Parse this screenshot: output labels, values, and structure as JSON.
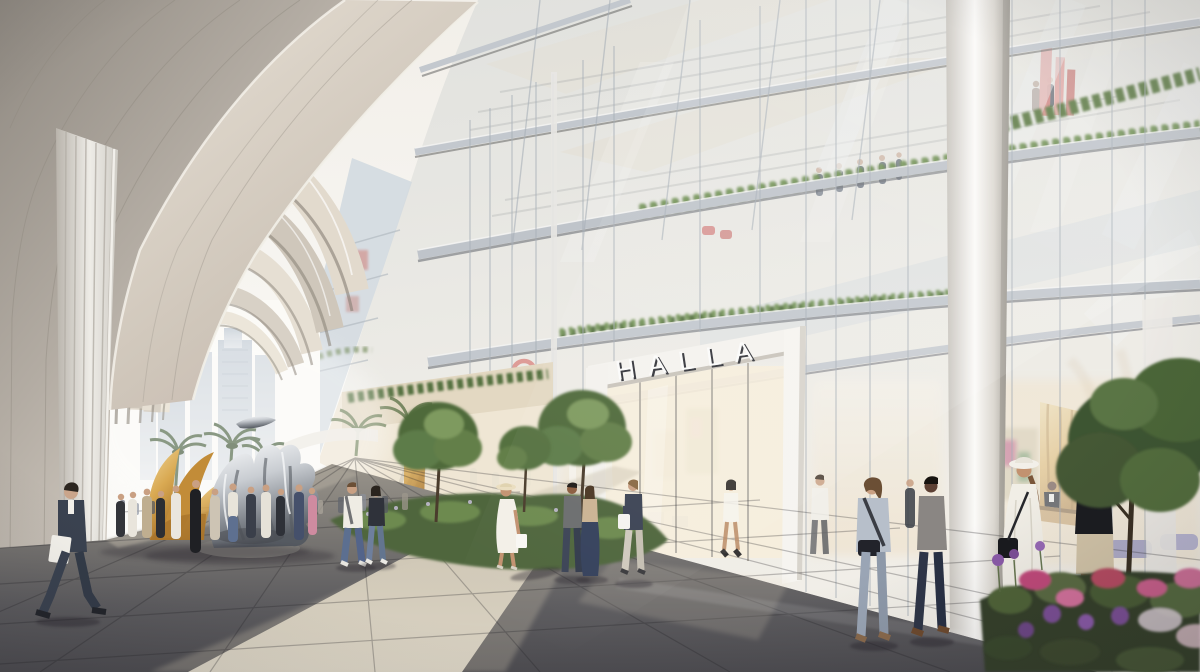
{
  "scene": {
    "type": "architectural-rendering",
    "description": "Sunlit pedestrian promenade beneath a colonnade of sweeping metallic arches, running alongside the tall glass facade of the HALLA building; shoppers stroll past a chrome figure sculpture, a gold winged sculpture, trees, flower beds and a glowing retail lobby.",
    "sign": {
      "text": "HALLA"
    }
  },
  "palette": {
    "sky": "#f5f2ec",
    "arch_light": "#e2dacd",
    "arch_mid": "#c2bab0",
    "arch_shadow": "#8e867d",
    "glass": "#dfe7ee",
    "glass_deep": "#b9c8d6",
    "mullion": "#a8b0b8",
    "sign_face": "#fbfbfa",
    "sign_shade": "#33343a",
    "interior_warm": "#f3e4c9",
    "ground_dark": "#4b4a4e",
    "ground_mid": "#6f6d6a",
    "ground_sunlit": "#d9d2c2",
    "greenery_dark": "#4f6a3b",
    "greenery_light": "#76955a",
    "gold": "#d9a952",
    "chrome_light": "#e9ecef",
    "chrome_dark": "#555a61",
    "accent_red": "#d24a3e",
    "flower_magenta": "#c04a7a",
    "flower_purple": "#7c4f96",
    "wood": "#c49a5e",
    "city_haze": "#c7cfd8",
    "purple_chair": "#7d77a6"
  },
  "elements": {
    "architecture": [
      "nested metallic vault arches",
      "ribbed arch pier",
      "glass curtain wall",
      "white entrance portal",
      "round white column",
      "balconies with hedge planters",
      "wood-slat reception wall"
    ],
    "sculptures": [
      "chrome figures sculpture",
      "gold wing sculpture"
    ],
    "vegetation": [
      "palm trees",
      "courtyard trees",
      "shrub planter",
      "flower bed",
      "street tree"
    ],
    "signage": [
      "HALLA fascia letters",
      "red ring store logo",
      "red art installation"
    ]
  },
  "people": {
    "foreground": [
      "man in dark suit carrying a laptop",
      "man in white t-shirt and jeans",
      "woman in black top and jeans",
      "woman in white dress with straw hat and shopping bag",
      "man in grey sweater at window",
      "woman in beige top and long navy skirt",
      "woman in navy blazer with white tote",
      "woman in striped blue shirt and jeans",
      "man in grey blazer and navy trousers",
      "woman in white dress and wide-brim hat",
      "man in black polo and beige shorts"
    ],
    "inside": [
      "woman in white mini dress",
      "man in white shirt",
      "concierge at reception desk",
      "seated cafe guests"
    ],
    "crowd": "group gathered around the sculptures",
    "balconies": "visitors on upper balconies"
  }
}
